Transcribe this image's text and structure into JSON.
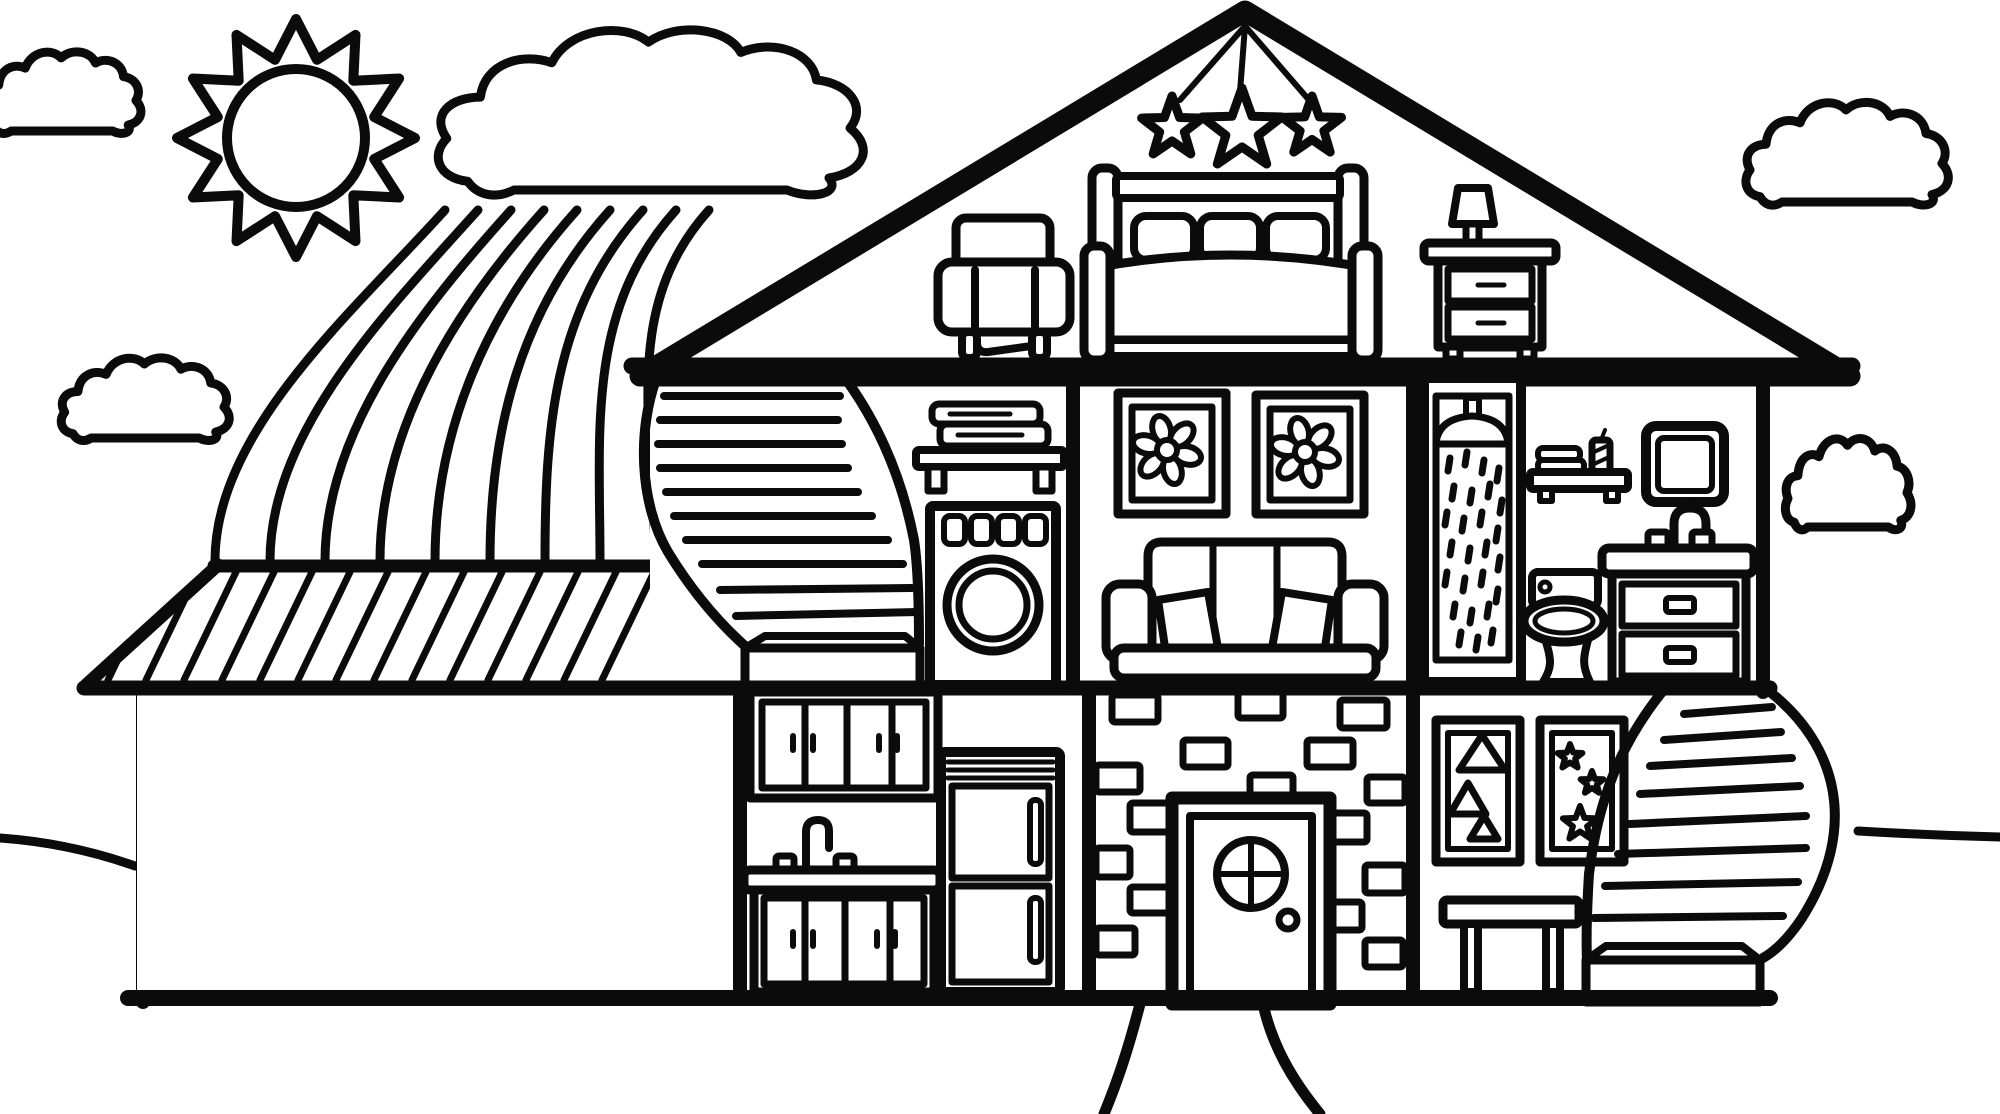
{
  "title": "House cross-section coloring page",
  "colors": {
    "ink": "#0b0b0b",
    "paper": "#ffffff"
  },
  "scene": {
    "style": "black-and-white line-art coloring book drawing",
    "subject": "cutaway two-story house with attic bedroom, garage with car, rainbow, sun and clouds"
  },
  "sky": {
    "sun": {
      "cx": 296,
      "cy": 138,
      "spike_count": 12,
      "outer_radius": 119,
      "valley_radius": 81,
      "disc_radius": 69
    },
    "clouds": [
      {
        "name": "top-left-cloud",
        "x": -20,
        "y": 46,
        "sx": 0.78,
        "sy": 0.85,
        "front": false
      },
      {
        "name": "mid-left-cloud",
        "x": 58,
        "y": 352,
        "sx": 0.83,
        "sy": 0.86,
        "front": false
      },
      {
        "name": "top-right-cloud",
        "x": 1742,
        "y": 95,
        "sx": 1.0,
        "sy": 1.07,
        "front": false
      },
      {
        "name": "mid-right-cloud",
        "x": 1783,
        "y": 432,
        "sx": 0.62,
        "sy": 0.95,
        "front": false
      },
      {
        "name": "big-rainbow-cloud",
        "x": 430,
        "y": 18,
        "sx": 2.1,
        "sy": 1.72,
        "front": true
      }
    ],
    "rainbow": {
      "band_count": 9,
      "top_x_start": 445,
      "top_x_step": 33,
      "top_y": 210,
      "bottom_x_start": 215,
      "bottom_x_step": 55,
      "bottom_y": 561
    }
  },
  "attic": {
    "hanging_stars": [
      {
        "cx": 1172,
        "cy": 128,
        "R": 32,
        "r": 13,
        "rot": -90
      },
      {
        "cx": 1242,
        "cy": 130,
        "R": 42,
        "r": 17,
        "rot": -90
      },
      {
        "cx": 1312,
        "cy": 127,
        "R": 31,
        "r": 12.5,
        "rot": -90
      }
    ],
    "furniture": [
      "armchair",
      "double-bed",
      "nightstand",
      "table-lamp"
    ]
  },
  "garage": {
    "contents": [
      "sedan-car"
    ],
    "car_wheels": {
      "centers": [
        [
          253,
          942
        ],
        [
          517,
          942
        ]
      ],
      "spoke_count": 10,
      "spoke_inner": 10,
      "spoke_outer": 27
    },
    "roof_hatch": {
      "x_start": 160,
      "x_step": 38,
      "count": 14,
      "y_top": 572,
      "y_bottom": 680,
      "lean_dx": -52
    }
  },
  "second_floor": {
    "left_room": {
      "items": [
        "spiral-staircase",
        "towel-shelf",
        "washing-machine"
      ]
    },
    "living_room": {
      "items": [
        "flower-picture",
        "flower-picture",
        "sofa"
      ],
      "flowers": {
        "centers": [
          [
            1167,
            450
          ],
          [
            1305,
            452
          ]
        ],
        "petal_count": 6,
        "petal_dist": 21,
        "petal_rx": 14,
        "petal_ry": 9,
        "center_r": 10
      }
    },
    "bathroom": {
      "items": [
        "shower-stall",
        "towel-shelf",
        "candle",
        "mirror",
        "sink-vanity",
        "toilet"
      ],
      "shower_drops": [
        [
          1450,
          458
        ],
        [
          1467,
          452
        ],
        [
          1484,
          460
        ],
        [
          1499,
          468
        ],
        [
          1454,
          486
        ],
        [
          1472,
          490
        ],
        [
          1490,
          484
        ],
        [
          1502,
          500
        ],
        [
          1447,
          512
        ],
        [
          1464,
          518
        ],
        [
          1482,
          512
        ],
        [
          1498,
          528
        ],
        [
          1452,
          542
        ],
        [
          1470,
          548
        ],
        [
          1487,
          542
        ],
        [
          1500,
          557
        ],
        [
          1447,
          572
        ],
        [
          1465,
          578
        ],
        [
          1483,
          572
        ],
        [
          1498,
          589
        ],
        [
          1455,
          604
        ],
        [
          1472,
          610
        ],
        [
          1489,
          604
        ],
        [
          1461,
          632
        ],
        [
          1478,
          637
        ],
        [
          1493,
          630
        ]
      ]
    }
  },
  "ground_floor": {
    "kitchen": {
      "items": [
        "upper-cabinets",
        "sink-counter",
        "lower-cabinets",
        "refrigerator"
      ]
    },
    "entry": {
      "items": [
        "brick-wall",
        "front-door",
        "walkway"
      ],
      "bricks": [
        [
          1112,
          695,
          46,
          27
        ],
        [
          1238,
          692,
          45,
          26
        ],
        [
          1340,
          700,
          47,
          28
        ],
        [
          1183,
          740,
          45,
          27
        ],
        [
          1307,
          740,
          46,
          27
        ],
        [
          1096,
          765,
          44,
          27
        ],
        [
          1250,
          775,
          43,
          25
        ],
        [
          1367,
          777,
          38,
          26
        ],
        [
          1130,
          803,
          43,
          29
        ],
        [
          1325,
          813,
          42,
          29
        ],
        [
          1096,
          848,
          34,
          29
        ],
        [
          1365,
          865,
          40,
          28
        ],
        [
          1130,
          887,
          42,
          26
        ],
        [
          1323,
          902,
          39,
          28
        ],
        [
          1096,
          928,
          39,
          27
        ],
        [
          1365,
          940,
          38,
          27
        ]
      ]
    },
    "right_room": {
      "items": [
        "triangle-picture",
        "star-picture",
        "side-table",
        "curved-staircase"
      ],
      "triangles": [
        [
          [
            1482,
            735
          ],
          [
            1459,
            770
          ],
          [
            1505,
            770
          ]
        ],
        [
          [
            1468,
            783
          ],
          [
            1450,
            814
          ],
          [
            1486,
            814
          ]
        ],
        [
          [
            1484,
            816
          ],
          [
            1470,
            839
          ],
          [
            1498,
            839
          ]
        ]
      ],
      "picture_stars": [
        {
          "cx": 1570,
          "cy": 757,
          "R": 13,
          "r": 5.5,
          "rot": -90
        },
        {
          "cx": 1592,
          "cy": 783,
          "R": 12,
          "r": 5,
          "rot": -90
        },
        {
          "cx": 1580,
          "cy": 824,
          "R": 18,
          "r": 7.5,
          "rot": -90
        }
      ]
    }
  },
  "staircases": {
    "left_steps": [
      [
        664,
        396,
        840,
        396
      ],
      [
        660,
        420,
        838,
        420
      ],
      [
        658,
        444,
        842,
        444
      ],
      [
        660,
        468,
        848,
        468
      ],
      [
        666,
        492,
        858,
        492
      ],
      [
        674,
        516,
        872,
        516
      ],
      [
        686,
        540,
        888,
        540
      ],
      [
        702,
        564,
        903,
        564
      ],
      [
        720,
        590,
        912,
        588
      ],
      [
        736,
        616,
        918,
        612
      ]
    ],
    "right_steps": [
      [
        1684,
        714,
        1772,
        707
      ],
      [
        1664,
        740,
        1781,
        732
      ],
      [
        1650,
        766,
        1792,
        758
      ],
      [
        1640,
        794,
        1800,
        786
      ],
      [
        1630,
        824,
        1806,
        816
      ],
      [
        1618,
        854,
        1806,
        848
      ],
      [
        1605,
        886,
        1798,
        882
      ],
      [
        1594,
        918,
        1783,
        916
      ]
    ]
  }
}
